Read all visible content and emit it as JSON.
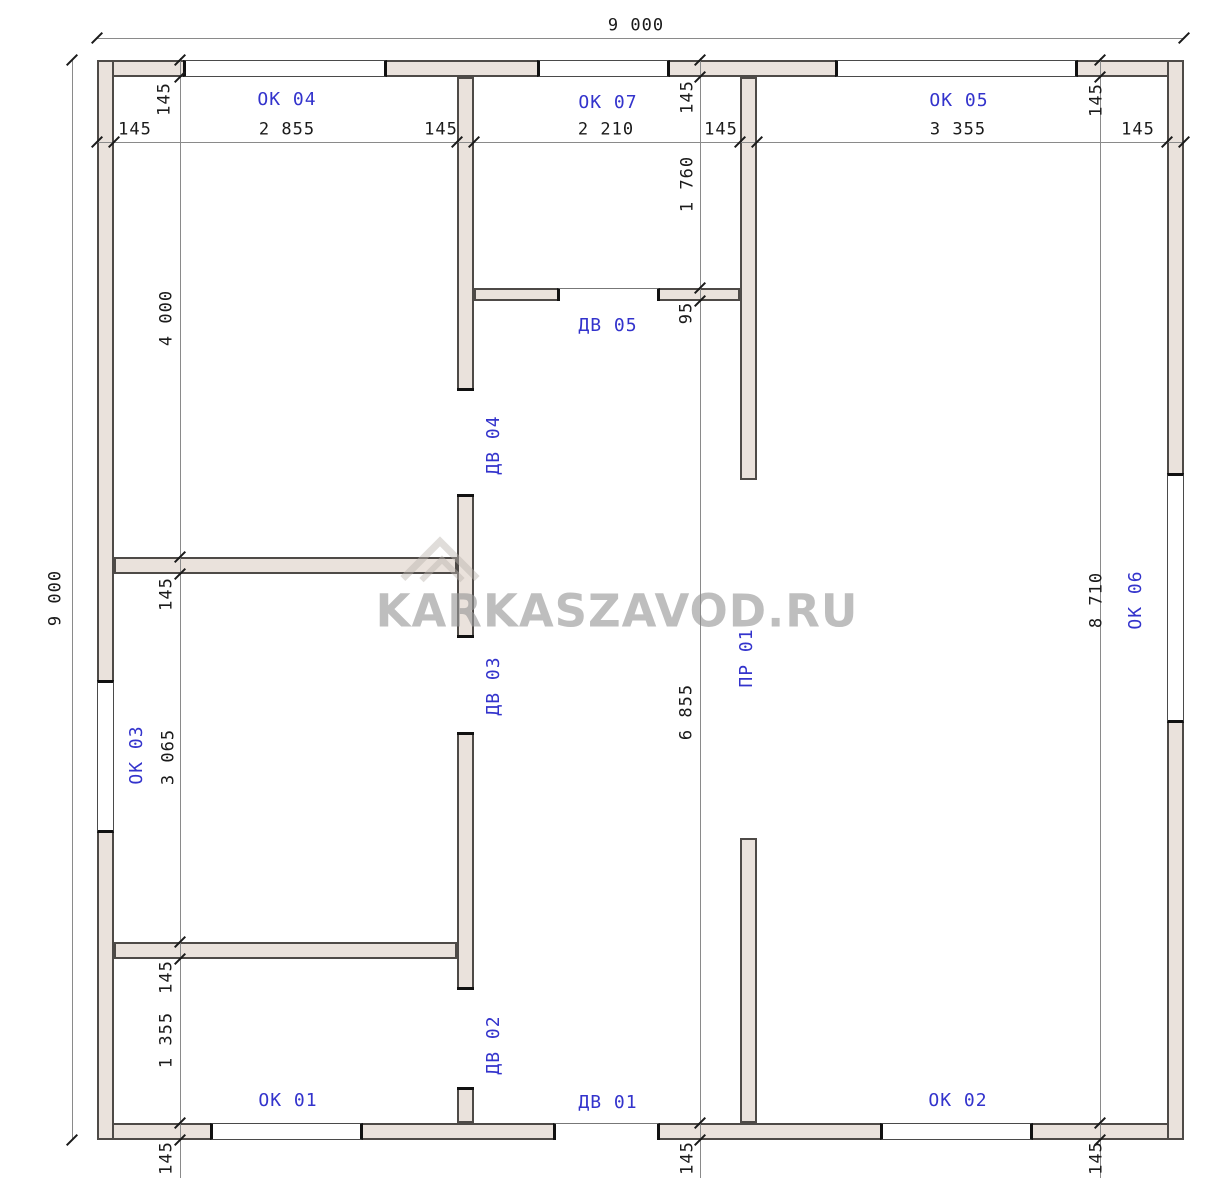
{
  "watermark": {
    "text": "KARKASZAVOD.RU"
  },
  "colors": {
    "bg": "#ffffff",
    "wall_fill": "#EAE2DC",
    "wall_stroke": "#4e4a47",
    "dim_line": "#8a8a8a",
    "tick": "#1a1a1a",
    "dim_text": "#1a1a1a",
    "accent_blue": "#3333cc",
    "watermark": "rgba(150,150,150,0.62)"
  },
  "plan": {
    "overall_width_label": "9 000",
    "overall_height_label": "9 000",
    "walls": [
      {
        "name": "wall-exterior-top",
        "x": 97,
        "y": 60,
        "w": 1087,
        "h": 17
      },
      {
        "name": "wall-exterior-bottom",
        "x": 97,
        "y": 1123,
        "w": 1087,
        "h": 17
      },
      {
        "name": "wall-exterior-left",
        "x": 97,
        "y": 60,
        "w": 17,
        "h": 1080
      },
      {
        "name": "wall-exterior-right",
        "x": 1167,
        "y": 60,
        "w": 17,
        "h": 1080
      },
      {
        "name": "wall-interior-vertical-left",
        "x": 457,
        "y": 77,
        "w": 17,
        "h": 1046
      },
      {
        "name": "wall-interior-vertical-right-upper",
        "x": 740,
        "y": 77,
        "w": 17,
        "h": 403
      },
      {
        "name": "wall-interior-vertical-right-lower",
        "x": 740,
        "y": 838,
        "w": 17,
        "h": 285
      },
      {
        "name": "wall-interior-horizontal-left-upper",
        "x": 114,
        "y": 557,
        "w": 343,
        "h": 17
      },
      {
        "name": "wall-interior-horizontal-left-lower",
        "x": 114,
        "y": 942,
        "w": 343,
        "h": 17
      },
      {
        "name": "wall-interior-horizontal-middle",
        "x": 474,
        "y": 288,
        "w": 266,
        "h": 13
      }
    ],
    "openings": [
      {
        "name": "window-ok04",
        "kind": "window",
        "orient": "h",
        "x": 183,
        "y": 60,
        "w": 204,
        "h": 17
      },
      {
        "name": "window-ok07",
        "kind": "window",
        "orient": "h",
        "x": 537,
        "y": 60,
        "w": 133,
        "h": 17
      },
      {
        "name": "window-ok05",
        "kind": "window",
        "orient": "h",
        "x": 835,
        "y": 60,
        "w": 243,
        "h": 17
      },
      {
        "name": "window-ok03",
        "kind": "window",
        "orient": "v",
        "x": 97,
        "y": 680,
        "w": 17,
        "h": 153
      },
      {
        "name": "window-ok06",
        "kind": "window",
        "orient": "v",
        "x": 1167,
        "y": 473,
        "w": 17,
        "h": 250
      },
      {
        "name": "window-ok01",
        "kind": "window",
        "orient": "h",
        "x": 210,
        "y": 1123,
        "w": 153,
        "h": 17
      },
      {
        "name": "window-ok02",
        "kind": "window",
        "orient": "h",
        "x": 880,
        "y": 1123,
        "w": 153,
        "h": 17
      },
      {
        "name": "door-dv01",
        "kind": "door",
        "orient": "h",
        "x": 553,
        "y": 1123,
        "w": 107,
        "h": 17
      },
      {
        "name": "door-dv05",
        "kind": "door",
        "orient": "h",
        "x": 557,
        "y": 288,
        "w": 103,
        "h": 13
      },
      {
        "name": "door-dv04",
        "kind": "door",
        "orient": "v",
        "x": 457,
        "y": 388,
        "w": 17,
        "h": 109
      },
      {
        "name": "door-dv03",
        "kind": "door",
        "orient": "v",
        "x": 457,
        "y": 635,
        "w": 17,
        "h": 100
      },
      {
        "name": "door-dv02",
        "kind": "door",
        "orient": "v",
        "x": 457,
        "y": 987,
        "w": 17,
        "h": 103
      }
    ],
    "dim_lines": [
      {
        "name": "dim-line-overall-top",
        "x1": 97,
        "y1": 38,
        "x2": 1184,
        "y2": 38
      },
      {
        "name": "dim-line-overall-left",
        "x1": 72,
        "y1": 60,
        "x2": 72,
        "y2": 1140
      },
      {
        "name": "dim-line-chain-top",
        "x1": 97,
        "y1": 142,
        "x2": 1184,
        "y2": 142
      },
      {
        "name": "dim-line-chain-left",
        "x1": 180,
        "y1": 58,
        "x2": 180,
        "y2": 1178
      },
      {
        "name": "dim-line-chain-middle",
        "x1": 700,
        "y1": 58,
        "x2": 700,
        "y2": 1178
      },
      {
        "name": "dim-line-chain-right",
        "x1": 1100,
        "y1": 58,
        "x2": 1100,
        "y2": 1178
      }
    ],
    "ticks": [
      {
        "x": 97,
        "y": 38
      },
      {
        "x": 1184,
        "y": 38
      },
      {
        "x": 72,
        "y": 60
      },
      {
        "x": 72,
        "y": 1140
      },
      {
        "x": 97,
        "y": 142
      },
      {
        "x": 114,
        "y": 142
      },
      {
        "x": 457,
        "y": 142
      },
      {
        "x": 474,
        "y": 142
      },
      {
        "x": 740,
        "y": 142
      },
      {
        "x": 757,
        "y": 142
      },
      {
        "x": 1167,
        "y": 142
      },
      {
        "x": 1184,
        "y": 142
      },
      {
        "x": 180,
        "y": 60
      },
      {
        "x": 180,
        "y": 77
      },
      {
        "x": 180,
        "y": 557
      },
      {
        "x": 180,
        "y": 574
      },
      {
        "x": 180,
        "y": 942
      },
      {
        "x": 180,
        "y": 959
      },
      {
        "x": 180,
        "y": 1123
      },
      {
        "x": 180,
        "y": 1140
      },
      {
        "x": 700,
        "y": 60
      },
      {
        "x": 700,
        "y": 77
      },
      {
        "x": 700,
        "y": 288
      },
      {
        "x": 700,
        "y": 301
      },
      {
        "x": 700,
        "y": 1123
      },
      {
        "x": 700,
        "y": 1140
      },
      {
        "x": 1100,
        "y": 60
      },
      {
        "x": 1100,
        "y": 77
      },
      {
        "x": 1100,
        "y": 1123
      },
      {
        "x": 1100,
        "y": 1140
      }
    ],
    "dim_labels": [
      {
        "text": "9 000",
        "x": 636,
        "y": 26,
        "rot": 0
      },
      {
        "text": "9 000",
        "x": 56,
        "y": 598,
        "rot": -90
      },
      {
        "text": "145",
        "x": 135,
        "y": 130,
        "rot": 0
      },
      {
        "text": "2 855",
        "x": 287,
        "y": 130,
        "rot": 0
      },
      {
        "text": "145",
        "x": 441,
        "y": 130,
        "rot": 0
      },
      {
        "text": "2 210",
        "x": 606,
        "y": 130,
        "rot": 0
      },
      {
        "text": "145",
        "x": 721,
        "y": 130,
        "rot": 0
      },
      {
        "text": "3 355",
        "x": 958,
        "y": 130,
        "rot": 0
      },
      {
        "text": "145",
        "x": 1138,
        "y": 130,
        "rot": 0
      },
      {
        "text": "145",
        "x": 165,
        "y": 99,
        "rot": -90
      },
      {
        "text": "4 000",
        "x": 167,
        "y": 318,
        "rot": -90
      },
      {
        "text": "145",
        "x": 167,
        "y": 594,
        "rot": -90
      },
      {
        "text": "3 065",
        "x": 169,
        "y": 757,
        "rot": -90
      },
      {
        "text": "145",
        "x": 167,
        "y": 977,
        "rot": -90
      },
      {
        "text": "1 355",
        "x": 167,
        "y": 1040,
        "rot": -90
      },
      {
        "text": "145",
        "x": 167,
        "y": 1158,
        "rot": -90
      },
      {
        "text": "145",
        "x": 688,
        "y": 97,
        "rot": -90
      },
      {
        "text": "1 760",
        "x": 688,
        "y": 184,
        "rot": -90
      },
      {
        "text": "95",
        "x": 687,
        "y": 313,
        "rot": -90
      },
      {
        "text": "6 855",
        "x": 687,
        "y": 712,
        "rot": -90
      },
      {
        "text": "145",
        "x": 688,
        "y": 1158,
        "rot": -90
      },
      {
        "text": "145",
        "x": 1097,
        "y": 100,
        "rot": -90
      },
      {
        "text": "8 710",
        "x": 1097,
        "y": 600,
        "rot": -90
      },
      {
        "text": "145",
        "x": 1097,
        "y": 1158,
        "rot": -90
      }
    ],
    "feature_labels": [
      {
        "text": "ОК 04",
        "x": 287,
        "y": 100,
        "rot": 0
      },
      {
        "text": "ОК 07",
        "x": 608,
        "y": 103,
        "rot": 0
      },
      {
        "text": "ОК 05",
        "x": 959,
        "y": 101,
        "rot": 0
      },
      {
        "text": "ОК 03",
        "x": 137,
        "y": 755,
        "rot": -90
      },
      {
        "text": "ОК 06",
        "x": 1136,
        "y": 600,
        "rot": -90
      },
      {
        "text": "ОК 01",
        "x": 288,
        "y": 1101,
        "rot": 0
      },
      {
        "text": "ДВ 01",
        "x": 608,
        "y": 1103,
        "rot": 0
      },
      {
        "text": "ОК 02",
        "x": 958,
        "y": 1101,
        "rot": 0
      },
      {
        "text": "ДВ 05",
        "x": 608,
        "y": 326,
        "rot": 0
      },
      {
        "text": "ДВ 04",
        "x": 494,
        "y": 445,
        "rot": -90
      },
      {
        "text": "ДВ 03",
        "x": 494,
        "y": 686,
        "rot": -90
      },
      {
        "text": "ДВ 02",
        "x": 494,
        "y": 1045,
        "rot": -90
      },
      {
        "text": "ПР 01",
        "x": 747,
        "y": 658,
        "rot": -90
      }
    ]
  }
}
